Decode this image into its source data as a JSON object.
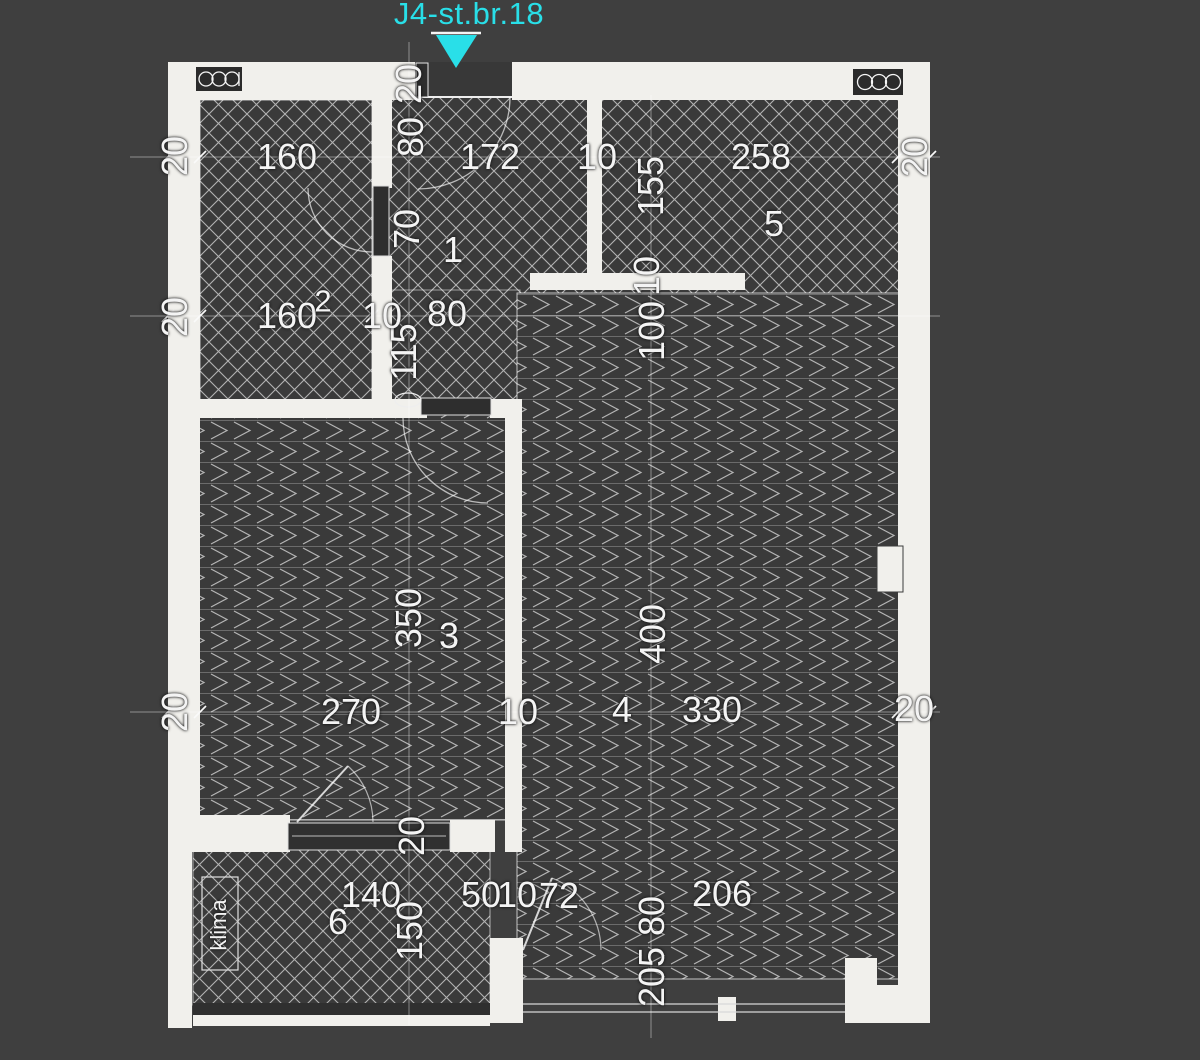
{
  "title": {
    "text": "J4-st.br.18"
  },
  "marker": {
    "shape": "down-triangle",
    "meaning": "entrance-pointer"
  },
  "colors": {
    "accent_cyan": "#29dfe8",
    "background": "#3f3f3f",
    "wall": "#f1f0ec",
    "room_fill": "#3a3a3a",
    "hatch_line": "#b3b3b3",
    "dim_text": "#f4f4f4",
    "door_dark": "#2e2e2e"
  },
  "rooms": [
    {
      "number": "1",
      "hatch": "cross"
    },
    {
      "number": "2",
      "hatch": "cross"
    },
    {
      "number": "3",
      "hatch": "herringbone"
    },
    {
      "number": "4",
      "hatch": "herringbone"
    },
    {
      "number": "5",
      "hatch": "cross"
    },
    {
      "number": "6",
      "hatch": "cross",
      "equipment": "klima"
    }
  ],
  "labels": [
    {
      "name": "dim-20-entrance",
      "text": "20",
      "x": 409,
      "y": 84,
      "rot": 1
    },
    {
      "name": "dim-80-entrance-door",
      "text": "80",
      "x": 411,
      "y": 137,
      "rot": 1
    },
    {
      "name": "dim-70-hall",
      "text": "70",
      "x": 407,
      "y": 229,
      "rot": 1
    },
    {
      "name": "dim-115-hall",
      "text": "115",
      "x": 404,
      "y": 352,
      "rot": 1
    },
    {
      "name": "dim-160-room2-top",
      "text": "160",
      "x": 287,
      "y": 157,
      "rot": 0
    },
    {
      "name": "dim-172-room1",
      "text": "172",
      "x": 490,
      "y": 157,
      "rot": 0
    },
    {
      "name": "dim-10-wall-1-5",
      "text": "10",
      "x": 597,
      "y": 157,
      "rot": 0
    },
    {
      "name": "dim-258-room5",
      "text": "258",
      "x": 761,
      "y": 157,
      "rot": 0
    },
    {
      "name": "dim-20-left-upper",
      "text": "20",
      "x": 175,
      "y": 156,
      "rot": 1
    },
    {
      "name": "dim-20-right-upper",
      "text": "20",
      "x": 915,
      "y": 157,
      "rot": 1
    },
    {
      "name": "dim-155-room5-wall",
      "text": "155",
      "x": 651,
      "y": 186,
      "rot": 1
    },
    {
      "name": "room-number-1",
      "text": "1",
      "x": 453,
      "y": 250,
      "rot": 0
    },
    {
      "name": "room-number-5",
      "text": "5",
      "x": 774,
      "y": 224,
      "rot": 0
    },
    {
      "name": "dim-160-room2-lower",
      "text": "160",
      "x": 287,
      "y": 316,
      "rot": 0
    },
    {
      "name": "room-number-2",
      "text": "2",
      "x": 323,
      "y": 301,
      "rot": 0,
      "size": 31
    },
    {
      "name": "dim-10-wall-2-1",
      "text": "10",
      "x": 382,
      "y": 316,
      "rot": 0
    },
    {
      "name": "dim-80-hall-mid",
      "text": "80",
      "x": 447,
      "y": 314,
      "rot": 0
    },
    {
      "name": "dim-20-left-middle",
      "text": "20",
      "x": 175,
      "y": 317,
      "rot": 1
    },
    {
      "name": "dim-10-room5-wall",
      "text": "10",
      "x": 647,
      "y": 276,
      "rot": 1
    },
    {
      "name": "dim-100-room4",
      "text": "100",
      "x": 652,
      "y": 331,
      "rot": 1
    },
    {
      "name": "dim-350-room3",
      "text": "350",
      "x": 409,
      "y": 618,
      "rot": 1
    },
    {
      "name": "room-number-3",
      "text": "3",
      "x": 449,
      "y": 636,
      "rot": 0
    },
    {
      "name": "dim-400-room4",
      "text": "400",
      "x": 653,
      "y": 634,
      "rot": 1
    },
    {
      "name": "dim-270-room3",
      "text": "270",
      "x": 351,
      "y": 712,
      "rot": 0
    },
    {
      "name": "dim-10-wall-3-4",
      "text": "10",
      "x": 518,
      "y": 712,
      "rot": 0
    },
    {
      "name": "room-number-4",
      "text": "4",
      "x": 622,
      "y": 710,
      "rot": 0
    },
    {
      "name": "dim-330-room4",
      "text": "330",
      "x": 712,
      "y": 710,
      "rot": 0
    },
    {
      "name": "dim-20-left-lower",
      "text": "20",
      "x": 175,
      "y": 712,
      "rot": 1
    },
    {
      "name": "dim-20-right-lower",
      "text": "20",
      "x": 914,
      "y": 709,
      "rot": 0
    },
    {
      "name": "dim-20-balcony-door",
      "text": "20",
      "x": 412,
      "y": 836,
      "rot": 1
    },
    {
      "name": "dim-140-balcony",
      "text": "140",
      "x": 371,
      "y": 895,
      "rot": 0
    },
    {
      "name": "room-number-6",
      "text": "6",
      "x": 338,
      "y": 922,
      "rot": 0
    },
    {
      "name": "dim-150-balcony",
      "text": "150",
      "x": 410,
      "y": 931,
      "rot": 1
    },
    {
      "name": "klima-label",
      "text": "klima",
      "x": 219,
      "y": 925,
      "rot": 1,
      "size": 22
    },
    {
      "name": "dim-50-bottom",
      "text": "50",
      "x": 481,
      "y": 895,
      "rot": 0
    },
    {
      "name": "dim-10-bottom",
      "text": "10",
      "x": 517,
      "y": 895,
      "rot": 0
    },
    {
      "name": "dim-72-bottom",
      "text": "72",
      "x": 559,
      "y": 896,
      "rot": 0
    },
    {
      "name": "dim-206-bottom",
      "text": "206",
      "x": 722,
      "y": 894,
      "rot": 0
    },
    {
      "name": "dim-80-terrace",
      "text": "80",
      "x": 652,
      "y": 916,
      "rot": 1
    },
    {
      "name": "dim-205-terrace",
      "text": "205",
      "x": 652,
      "y": 977,
      "rot": 1
    }
  ]
}
